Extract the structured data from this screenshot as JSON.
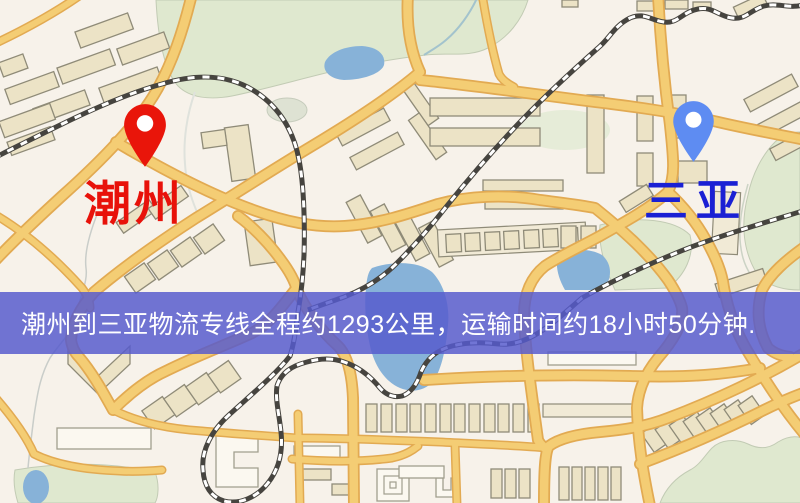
{
  "banner": {
    "text": "潮州到三亚物流专线全程约1293公里，运输时间约18小时50分钟.",
    "distance_km": "1293",
    "transport_time": "18小时50分钟",
    "background_color": "#565acd",
    "text_color": "#ffffff"
  },
  "origin": {
    "name": "潮州",
    "pin_icon": "red-map-pin",
    "pin_color": "#e9150a",
    "label_color": "#e8120a"
  },
  "destination": {
    "name": "三亚",
    "pin_icon": "blue-map-pin",
    "pin_color": "#5e8cf2",
    "label_color": "#1a20d4"
  },
  "map_palette": {
    "background": "#f7f2ea",
    "road_fill": "#f4cd74",
    "road_casing": "#e2aa52",
    "railway": "#46443f",
    "water": "#87b2d8",
    "park": "#dfe8cf",
    "building_fill": "#ece3c6",
    "building_outline": "#8f8b78"
  }
}
